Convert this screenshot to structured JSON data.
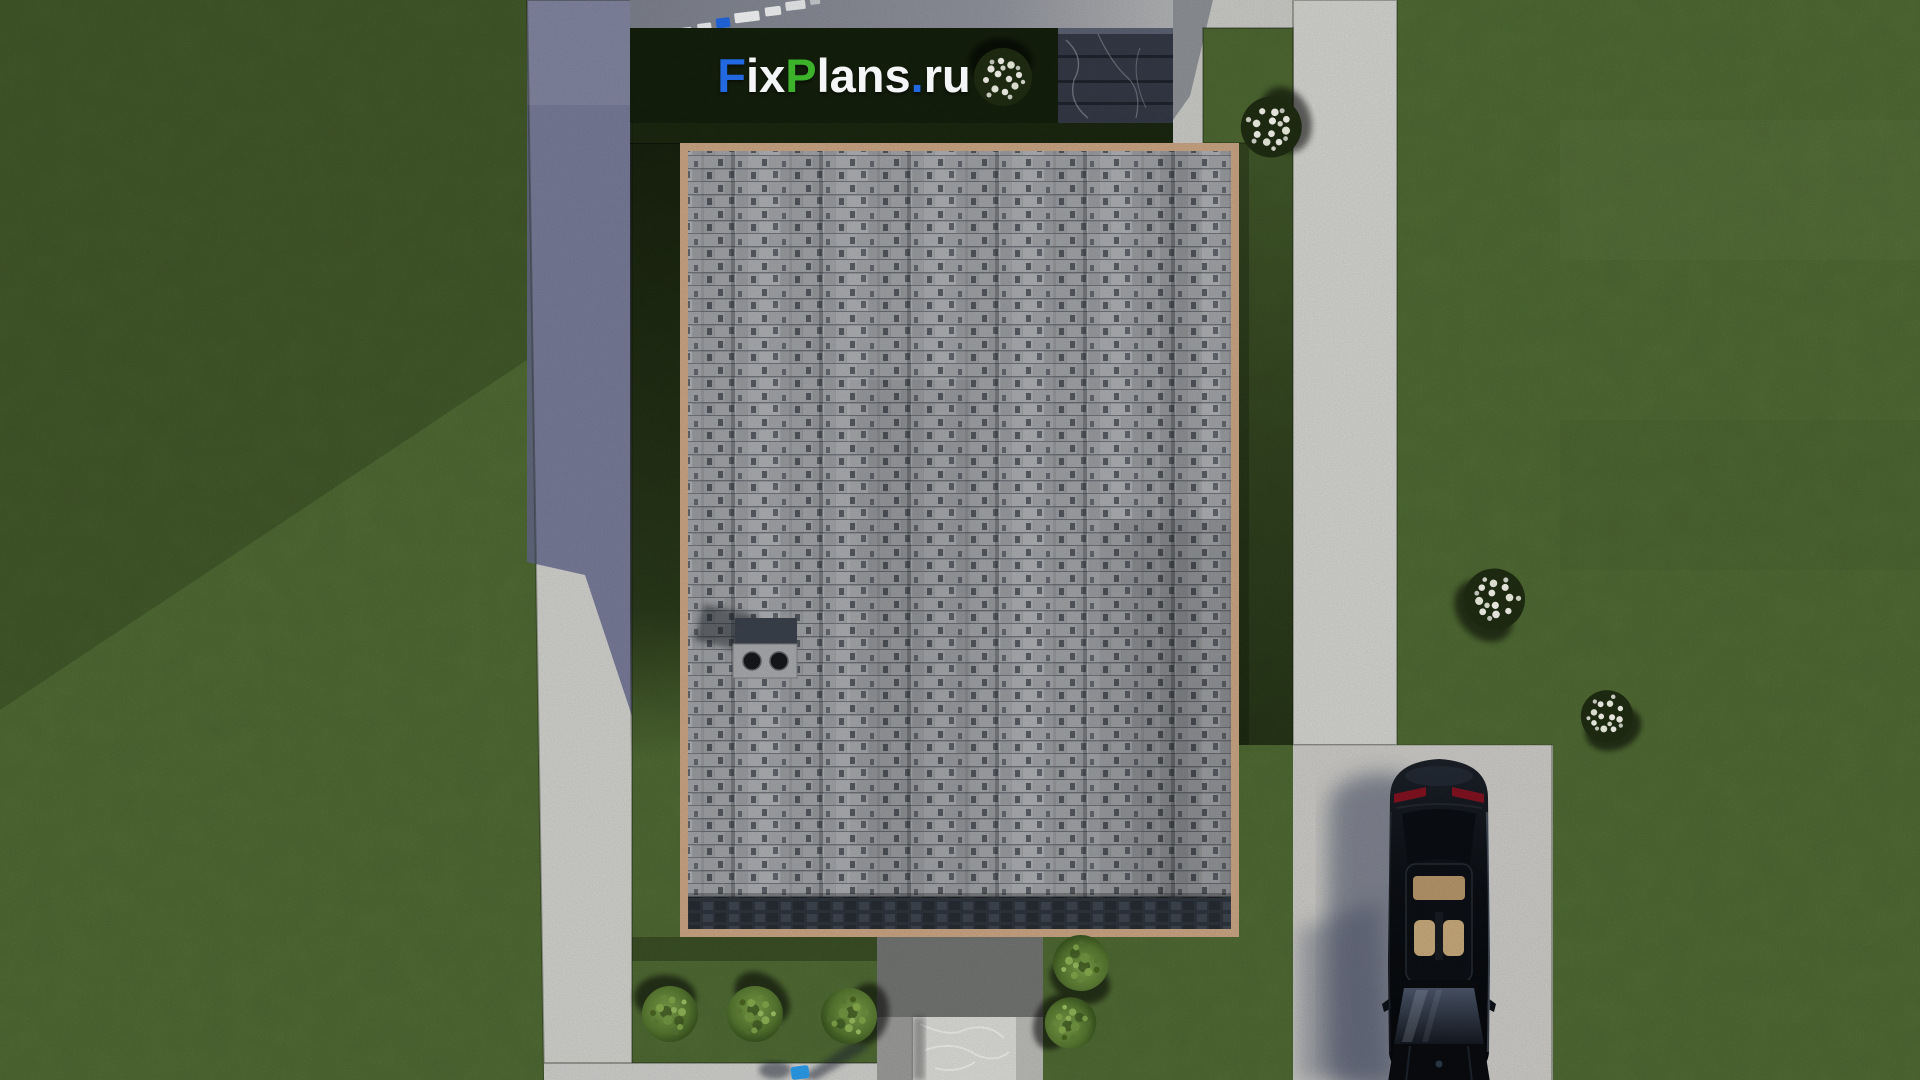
{
  "watermark": {
    "text": "FixPlans.ru",
    "segments": [
      {
        "text": "F",
        "color": "#2268e0"
      },
      {
        "text": "ix",
        "color": "#f4f5f6"
      },
      {
        "text": "P",
        "color": "#3cb22a"
      },
      {
        "text": "lans",
        "color": "#f4f5f6"
      },
      {
        "text": ".",
        "color": "#2268e0"
      },
      {
        "text": "ru",
        "color": "#f4f5f6"
      }
    ]
  },
  "scene": {
    "type": "3d-architectural-site-plan-top-down-render",
    "objects": [
      "lawn",
      "asphalt-road-left",
      "concrete-walkway-right",
      "concrete-driveway",
      "gray-shingle-roof",
      "tan-roof-trim",
      "chimney-with-two-vents",
      "dark-stone-steps",
      "rear-porch",
      "marble-entry-slab",
      "black-sedan-top-view",
      "green-shrubs",
      "white-flowering-shrubs",
      "person-in-blue",
      "road-lane-dashes"
    ],
    "counts": {
      "green_shrubs": 6,
      "white_flower_shrubs": 4,
      "cars": 1
    },
    "palette": {
      "lawn": "#4f6a33",
      "lawn_shadow": "#141f0b",
      "road_shadowed": "#6e7490",
      "walkway_light": "#d1d1cd",
      "driveway": "#cac9c5",
      "roof_shingles": "#9da0a4",
      "roof_trim": "#c7a382",
      "roof_eave_dark": "#2e343c",
      "steps_stone": "#333945",
      "porch": "#717370",
      "marble_slab": "#d9d9d6",
      "car_body": "#0b0e13",
      "car_interior": "#c2a477",
      "car_taillight": "#8c1220",
      "shrub_green": "#5c7c33",
      "flower_white": "#f2f2ea",
      "figure_blue": "#2a9be8"
    }
  }
}
